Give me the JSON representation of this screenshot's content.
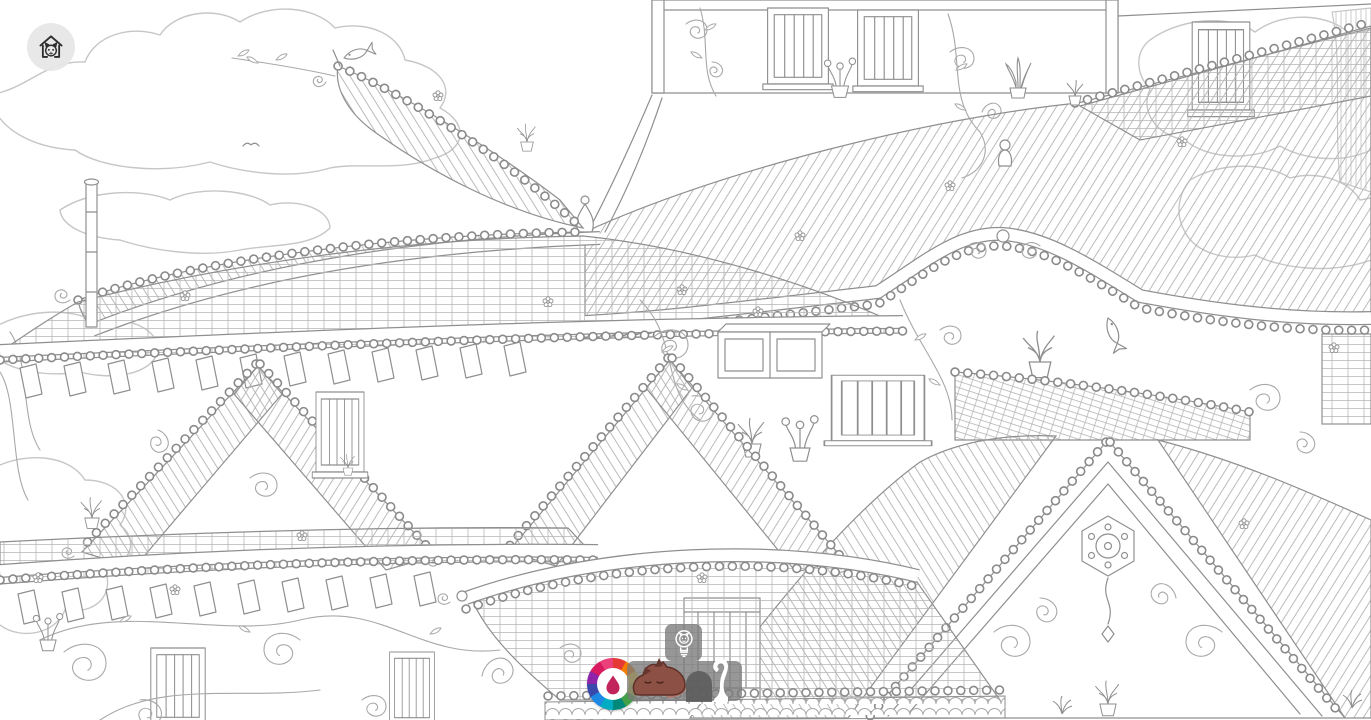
{
  "app": {
    "header": {
      "home_button": {
        "icon": "cat-house-icon",
        "badge_color": "rgba(231,231,231,0.95)",
        "glyph_color": "#2e2e2e"
      }
    },
    "toolbar": {
      "overlay_color": "rgba(122,122,122,0.78)",
      "palette_button": {
        "icon": "color-wheel-icon",
        "wheel_colors": [
          "#e53935",
          "#f57c00",
          "#fdd835",
          "#c0ca33",
          "#43a047",
          "#00897b",
          "#00acc1",
          "#1e88e5",
          "#3949ab",
          "#8e24aa",
          "#d81b60",
          "#ec407a"
        ],
        "drop_color": "#c2255c"
      },
      "hint_button": {
        "icon": "lightbulb-cat-icon",
        "glyph_color": "#ffffff"
      },
      "found_bar": {
        "items": [
          {
            "name": "sleeping-cat",
            "state": "found",
            "body_color": "#8d5044",
            "ear_color": "#66362e",
            "outline_color": "#5d3129",
            "tail_color": "#b4766a",
            "tail_tip_color": "#e7b6ad"
          },
          {
            "name": "cat-silhouette",
            "state": "not-found",
            "color": "rgba(92,92,92,0.9)"
          },
          {
            "name": "cat-tail-silhouette",
            "state": "not-found",
            "color": "#ffffff"
          }
        ]
      }
    },
    "canvas": {
      "background_color": "#ffffff",
      "line_color": "#8f8f8f",
      "soft_line_color": "#c6c6c6",
      "scene_elements": [
        "clouds",
        "corner-trees",
        "willow-branches",
        "upper-wall-with-slatted-windows",
        "potted-plants",
        "vine-scrolls",
        "large-tiled-roof",
        "pagoda-roof-with-fish-finial",
        "bead-tile-ridges",
        "shuttered-windows",
        "lattice-windows",
        "triangular-gable-with-ornament",
        "scalloped-eave",
        "roof-figurine"
      ]
    }
  }
}
